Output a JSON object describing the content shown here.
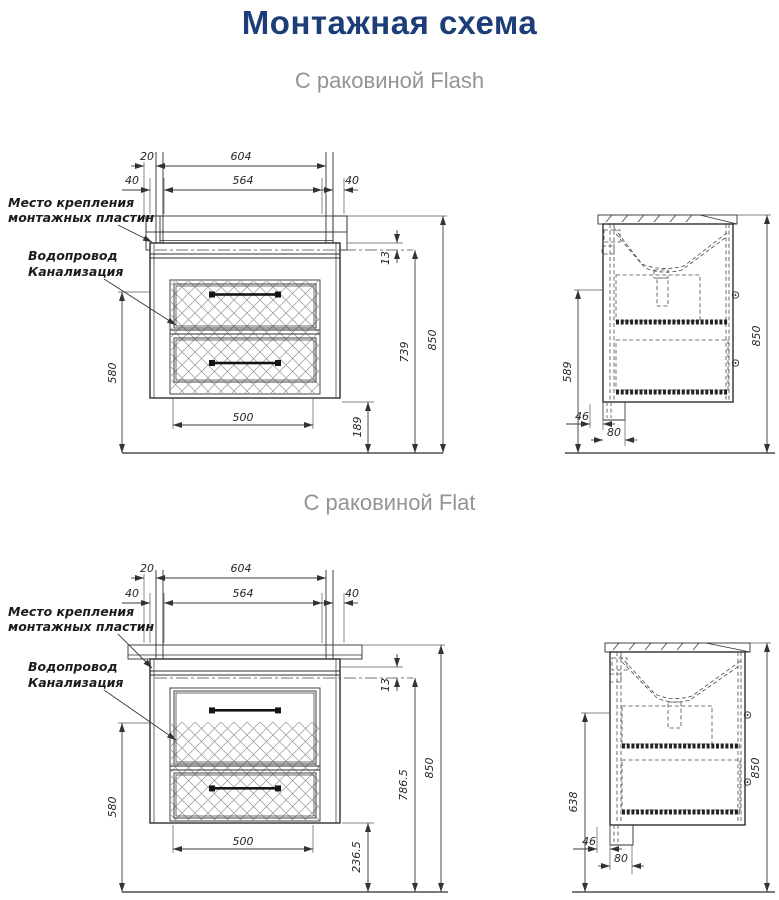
{
  "page": {
    "title": "Монтажная схема"
  },
  "colors": {
    "title": "#1d3d78",
    "subtitle": "#949494",
    "linework": "#2f2f2f"
  },
  "flash": {
    "subtitle": "С раковиной Flash",
    "labels": {
      "mounting_line1": "Место крепления",
      "mounting_line2": "монтажных пластин",
      "water_supply": "Водопровод",
      "sewerage": "Канализация"
    },
    "front_dims": {
      "stud_spacing": "20",
      "mounting_span": "604",
      "left_offset": "40",
      "plate_span": "564",
      "right_offset": "40",
      "plate_below_top": "13",
      "plate_height": "739",
      "total_height": "850",
      "supply_height": "580",
      "drain_span": "500",
      "cabinet_bottom_height": "189"
    },
    "side_dims": {
      "supply_height": "589",
      "back_clearance": "46",
      "drain_offset": "80",
      "total_height": "850"
    }
  },
  "flat": {
    "subtitle": "С раковиной Flat",
    "labels": {
      "mounting_line1": "Место крепления",
      "mounting_line2": "монтажных пластин",
      "water_supply": "Водопровод",
      "sewerage": "Канализация"
    },
    "front_dims": {
      "stud_spacing": "20",
      "mounting_span": "604",
      "left_offset": "40",
      "plate_span": "564",
      "right_offset": "40",
      "plate_below_top": "13",
      "plate_height": "786.5",
      "total_height": "850",
      "supply_height": "580",
      "drain_span": "500",
      "cabinet_bottom_height": "236.5"
    },
    "side_dims": {
      "supply_height": "638",
      "back_clearance": "46",
      "drain_offset": "80",
      "total_height": "850"
    }
  }
}
